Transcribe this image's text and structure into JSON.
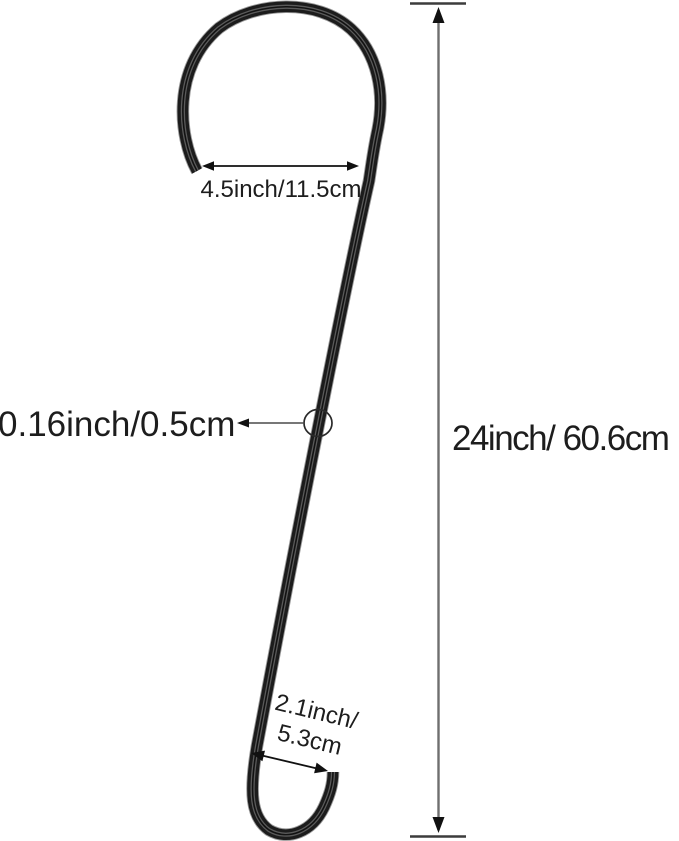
{
  "canvas": {
    "background": "#ffffff"
  },
  "diagram": {
    "labels": {
      "hook_opening": "4.5inch/11.5cm",
      "wire_thickness": "0.16inch/0.5cm",
      "total_length": "24inch/ 60.6cm",
      "bottom_hook_line1": "2.1inch/",
      "bottom_hook_line2": "5.3cm"
    },
    "colors": {
      "background": "#ffffff",
      "wire": "#1c1c1c",
      "wire_highlight": "#5a5a5a",
      "wire_halo": "#9a9a9a",
      "dimension_line": "#6f6f6f",
      "arrow": "#111111",
      "text": "#1d1d1d"
    }
  }
}
